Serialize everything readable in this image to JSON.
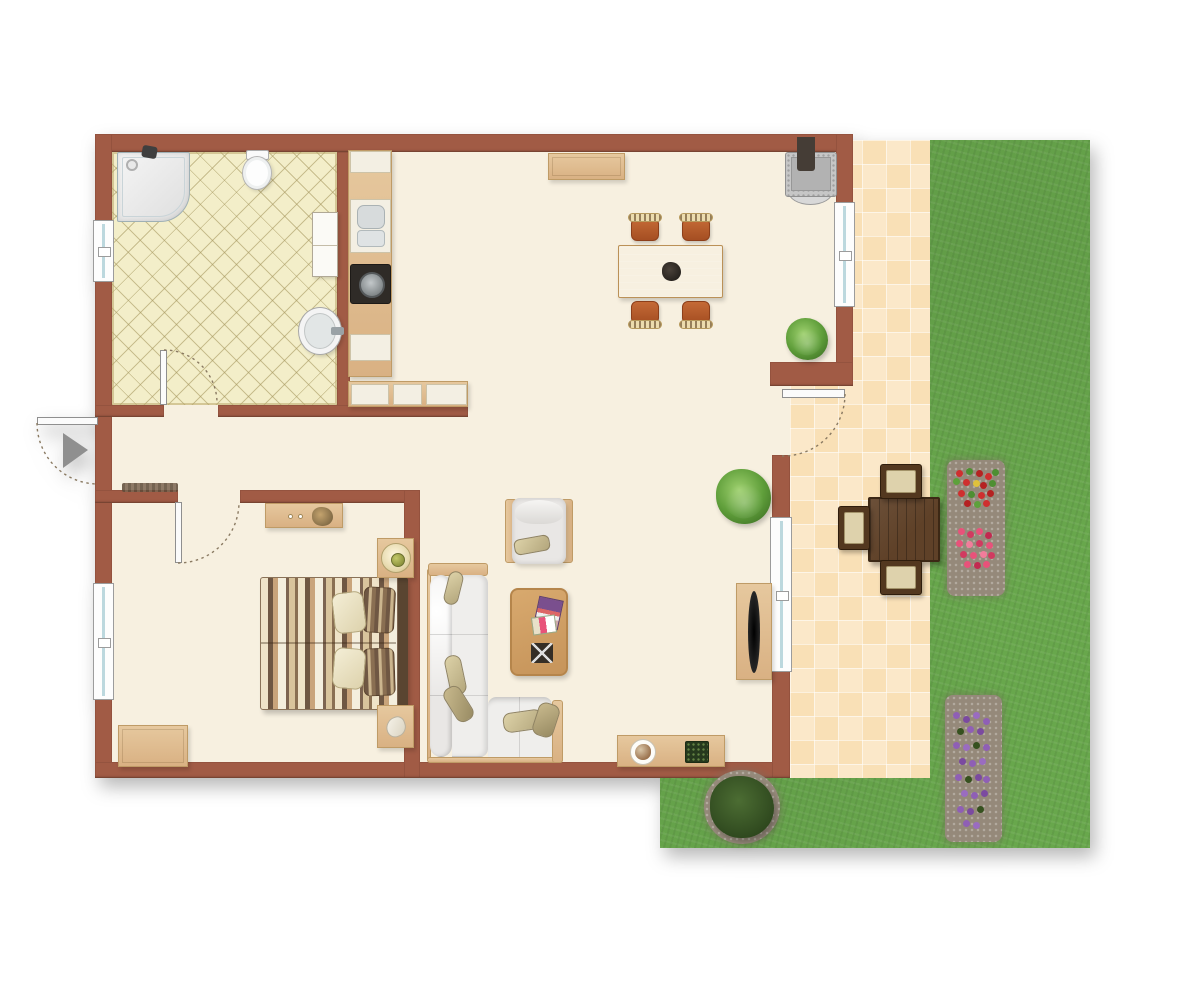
{
  "scene": {
    "type": "apartment-floor-plan-with-garden",
    "rooms": [
      "bathroom",
      "kitchen",
      "living-dining-room",
      "hallway",
      "bedroom",
      "patio",
      "garden"
    ],
    "fixtures": {
      "bathroom": [
        "shower",
        "toilet",
        "cabinet",
        "round-sink",
        "tiled-floor",
        "window",
        "door"
      ],
      "kitchen": [
        "counter-strip",
        "kitchen-sink",
        "stove",
        "cabinets",
        "l-shaped-counter"
      ],
      "living_dining": [
        "sideboard",
        "fireplace-with-chimney",
        "dining-table",
        "four-dining-chairs",
        "centerpiece-bowl",
        "potted-plant-corner",
        "potted-plant-mid",
        "armchair",
        "coffee-table",
        "magazines",
        "tray",
        "l-shaped-sofa",
        "throw-pillows",
        "tv-stand",
        "tv",
        "low-sideboard",
        "pet-bowl",
        "plant-box",
        "window-upper",
        "window-lower",
        "patio-door"
      ],
      "bedroom": [
        "dresser",
        "double-bed-striped",
        "two-cream-pillows",
        "two-striped-pillows",
        "headboard",
        "nightstand-with-lamp",
        "nightstand-with-shell",
        "bench",
        "window",
        "door",
        "doormat"
      ],
      "outdoor": [
        "patio-tiles",
        "garden-grass",
        "outdoor-table",
        "three-outdoor-chairs",
        "flower-bed-red",
        "flower-bed-pink",
        "flower-bed-purple",
        "bush",
        "mulch-patches"
      ],
      "entrance": [
        "entrance-door",
        "entrance-arrow"
      ]
    },
    "door_swings": [
      "entrance-outward",
      "bathroom-inward",
      "bedroom-inward",
      "patio-outward"
    ]
  },
  "palette": {
    "wall": "#a15b45",
    "wall-edge": "#8a4b38",
    "floor": "#f7f0e0",
    "bath-tile": "#f3eec9",
    "bath-grout": "#a4955c",
    "patio-a": "#f9e0b6",
    "patio-b": "#fbe8c9",
    "grass": "#68a74c",
    "wood": "#d9b183",
    "wood-dark": "#bf9b66",
    "wood-light": "#e6c89e",
    "counter-white": "#f3efe3",
    "chair-rust": "#b65c2c",
    "cushion-cream": "#ecdcae",
    "sofa-white": "#e9e7e5",
    "pillow-beige": "#cdbf96",
    "bed-brown": "#6f5743",
    "bed-tan": "#c9a47b",
    "bed-cream": "#efe3c8",
    "outdoor-wood": "#5f4128",
    "outdoor-cushion": "#ded2ac",
    "mulch": "#95897a",
    "flower-red": "#cf2f2f",
    "flower-pink": "#e8527a",
    "flower-purple": "#8f5fb5",
    "plant-green": "#5f9e3a",
    "stove-dark": "#2f2b27",
    "fire-gray": "#c6c6c6",
    "window-glass": "#bcd8de",
    "door-arc": "#8a7a62",
    "arrow-gray": "#8f8f8f"
  }
}
